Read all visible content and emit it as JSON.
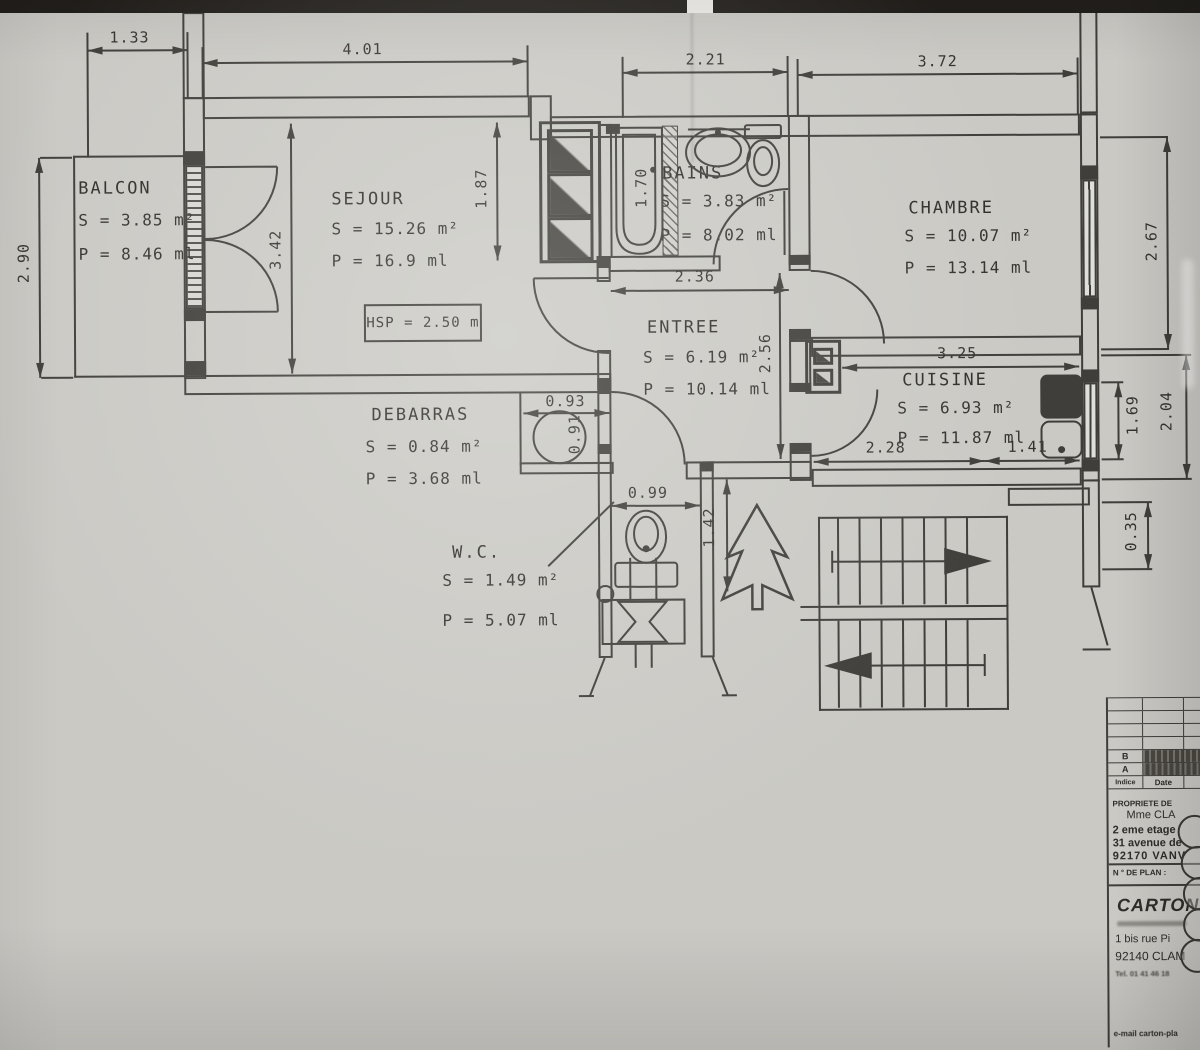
{
  "rooms": [
    {
      "id": "balcon",
      "name": "BALCON",
      "s": "S =  3.85 m²",
      "p": "P =  8.46 ml"
    },
    {
      "id": "sejour",
      "name": "SEJOUR",
      "s": "S =  15.26 m²",
      "p": "P =  16.9 ml"
    },
    {
      "id": "bains",
      "name": "BAINS",
      "s": "S =  3.83 m²",
      "p": "P =  8.02 ml"
    },
    {
      "id": "chambre",
      "name": "CHAMBRE",
      "s": "S =  10.07 m²",
      "p": "P =  13.14 ml"
    },
    {
      "id": "entree",
      "name": "ENTREE",
      "s": "S =  6.19 m²",
      "p": "P =  10.14 ml"
    },
    {
      "id": "cuisine",
      "name": "CUISINE",
      "s": "S =  6.93 m²",
      "p": "P =  11.87 ml"
    },
    {
      "id": "debarras",
      "name": "DEBARRAS",
      "s": "S =  0.84 m²",
      "p": "P =  3.68 ml"
    },
    {
      "id": "wc",
      "name": "W.C.",
      "s": "S =  1.49 m²",
      "p": "P =  5.07 ml"
    }
  ],
  "annotations": {
    "hsp": "HSP = 2.50 m"
  },
  "dims": [
    "1.33",
    "4.01",
    "2.21",
    "3.72",
    "2.90",
    "3.42",
    "1.87",
    "1.70",
    "2.36",
    "2.56",
    "2.67",
    "3.25",
    "2.28",
    "1.41",
    "1.69",
    "2.04",
    "0.35",
    "0.93",
    "0.91",
    "0.99",
    "1.42"
  ],
  "title_block": {
    "revisions": {
      "col_indice": "Indice",
      "col_date": "Date",
      "rows": [
        {
          "indice": "B"
        },
        {
          "indice": "A"
        }
      ]
    },
    "owner_label": "PROPRIETE DE",
    "owner_name": "Mme CLA",
    "floor_line": "2 eme etage",
    "street_line": "31 avenue de",
    "city_line": "92170  VANV",
    "plan_number_label": "N ° DE PLAN :",
    "architect_name": "CARTON",
    "architect_address1": "1 bis rue Pi",
    "architect_address2": "92140 CLAM",
    "architect_tel": "Tel. 01 41 46 18",
    "architect_email": "e-mail carton-pla"
  }
}
